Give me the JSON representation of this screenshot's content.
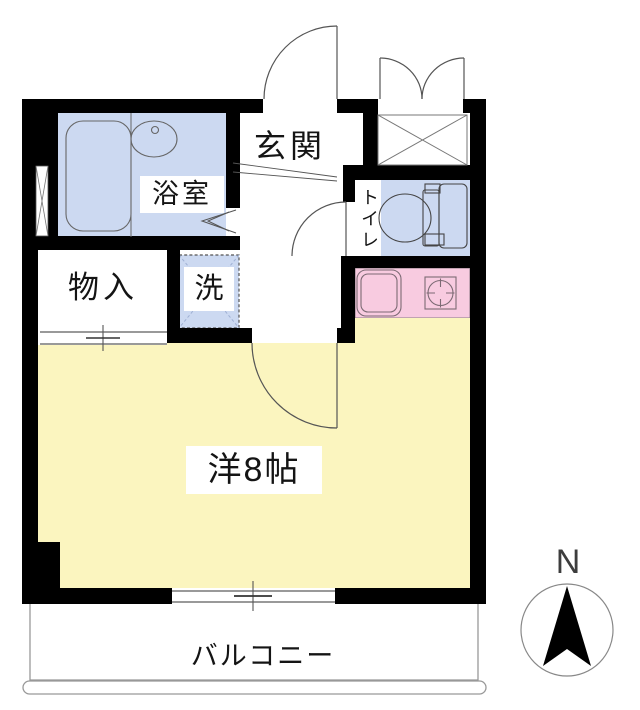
{
  "plan": {
    "rooms": {
      "entrance": {
        "label": "玄関"
      },
      "bathroom": {
        "label": "浴室"
      },
      "toilet": {
        "label": "トイレ"
      },
      "storage": {
        "label": "物入"
      },
      "laundry": {
        "label": "洗"
      },
      "main_room": {
        "label": "洋8帖"
      },
      "balcony": {
        "label": "バルコニー"
      }
    },
    "compass": {
      "north_label": "N"
    },
    "colors": {
      "wall": "#000000",
      "wet_area_fill": "#ccd9f1",
      "room_fill": "#fbf5bf",
      "kitchen_fill": "#f8cbe0",
      "fixture_line": "#555555",
      "balcony_line": "#999999"
    }
  }
}
